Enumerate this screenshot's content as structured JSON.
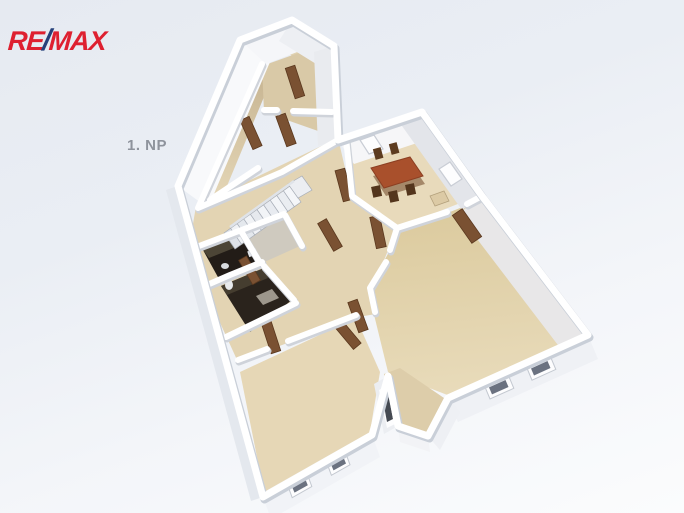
{
  "brand": {
    "re": "RE",
    "slash": "/",
    "max": "MAX",
    "red": "#de2030",
    "blue": "#26407a"
  },
  "floor_label": "1. NP",
  "scene": {
    "description_of_pixels": "3D isometric rendering of a first-floor plan: white walls, tan floors, brown doors, dining table with chairs, staircase, two dark bathroom rooms, exterior windows, recessed entrance",
    "palette": {
      "background_top": "#e7ebf1",
      "background_bottom": "#fbfcfd",
      "wall_white": "#ffffff",
      "wall_shadow": "#c9cfd8",
      "wall_face_light": "#f6f7f9",
      "wall_face_grey": "#e3e5ea",
      "floor_tan": "#e3d4b2",
      "floor_tan_dark": "#d6c5a2",
      "bathroom_dark": "#27211b",
      "door_brown": "#7a5132",
      "table_brown": "#a9502c",
      "chair_brown": "#5d3c20",
      "stair_tread": "#f0f2f5"
    }
  }
}
